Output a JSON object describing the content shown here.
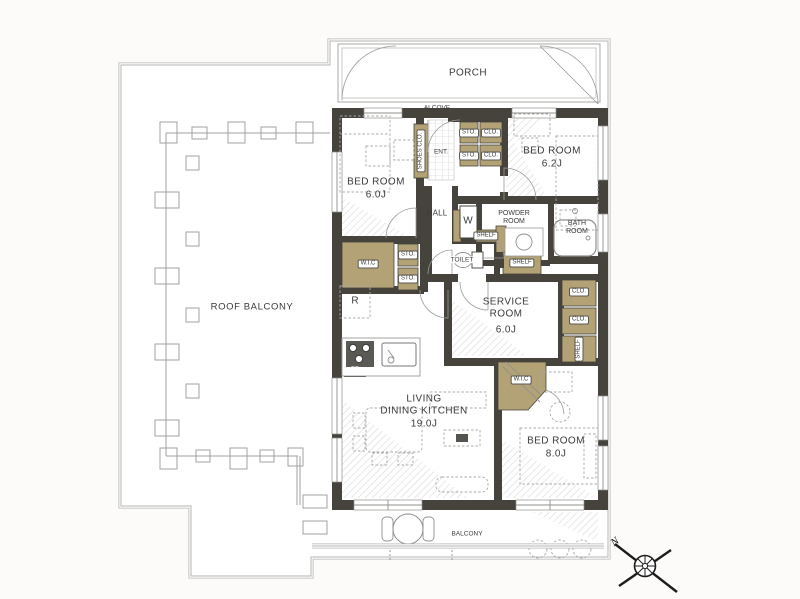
{
  "rooms": {
    "porch": "PORCH",
    "alcove": "ALCOVE",
    "entrance": "ENT.",
    "hall": "HALL",
    "bedroom_nw": {
      "name": "BED ROOM",
      "size": "6.0J"
    },
    "bedroom_ne": {
      "name": "BED ROOM",
      "size": "6.2J"
    },
    "bedroom_se": {
      "name": "BED ROOM",
      "size": "8.0J"
    },
    "service_room": {
      "name": "SERVICE ROOM",
      "size": "6.0J"
    },
    "ldk": {
      "line1": "LIVING",
      "line2": "DINING KITCHEN",
      "size": "19.0J"
    },
    "powder_room": "POWDER ROOM",
    "bath_room": "BATH ROOM",
    "toilet": "TOILET",
    "balcony": "BALCONY",
    "roof_balcony": "ROOF BALCONY"
  },
  "storage": {
    "shoes_closet": "SHOES CLO.",
    "storage": "STO.",
    "closet": "CLO.",
    "shelf": "SHELF",
    "walk_in_closet": "W.I.C",
    "washer": "W",
    "refrigerator": "R",
    "pipe_space": "FS"
  },
  "compass": {
    "north_label": "N"
  },
  "colors": {
    "wall-color": "#45433c",
    "storage-color": "#b3a276",
    "line-color": "#9a9a98",
    "background-color": "#fcfbf9"
  }
}
